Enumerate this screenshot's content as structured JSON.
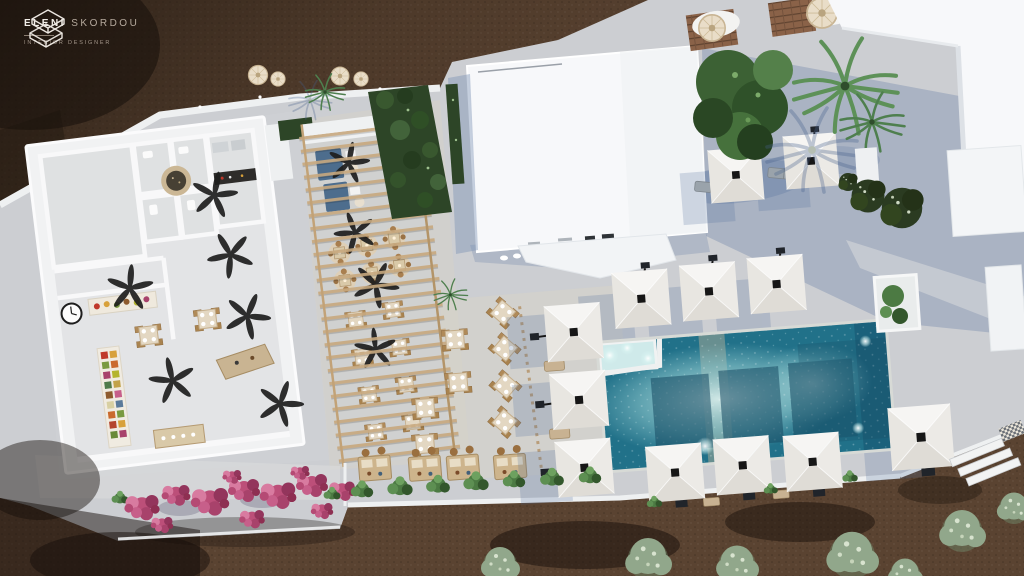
{
  "brand": {
    "name_primary": "ELENI",
    "name_secondary": "SKORDOU",
    "subtitle": "INTERIOR DESIGNER"
  },
  "icons": {
    "logo_mark": "stacked-isometric-s-monogram"
  },
  "colors": {
    "soil_base": "#5a4331",
    "soil_dark": "#35271d",
    "soil_shadow": "#17100b",
    "pavement": "#ccced2",
    "pavement_warm": "#d8d3c7",
    "wall_white": "#f1f2f3",
    "building_white": "#f7f8fa",
    "shadow_blue": "#4f6d9c",
    "pool_deep": "#217189",
    "pool_light": "#c6e7e7",
    "pool_shadow": "#174b63",
    "parasol_light": "#f6f5f3",
    "parasol_mid": "#eceae6",
    "parasol_dark": "#dfdcd6",
    "wood": "#c2a277",
    "beige": "#cfb893",
    "hedge": "#2d4527",
    "leaf": "#4c7a43",
    "palm": "#57925a",
    "olive": "#91a78b",
    "flower": "#bc4f79",
    "denim": "#4d6d8d",
    "glow": "#ffc97a"
  }
}
